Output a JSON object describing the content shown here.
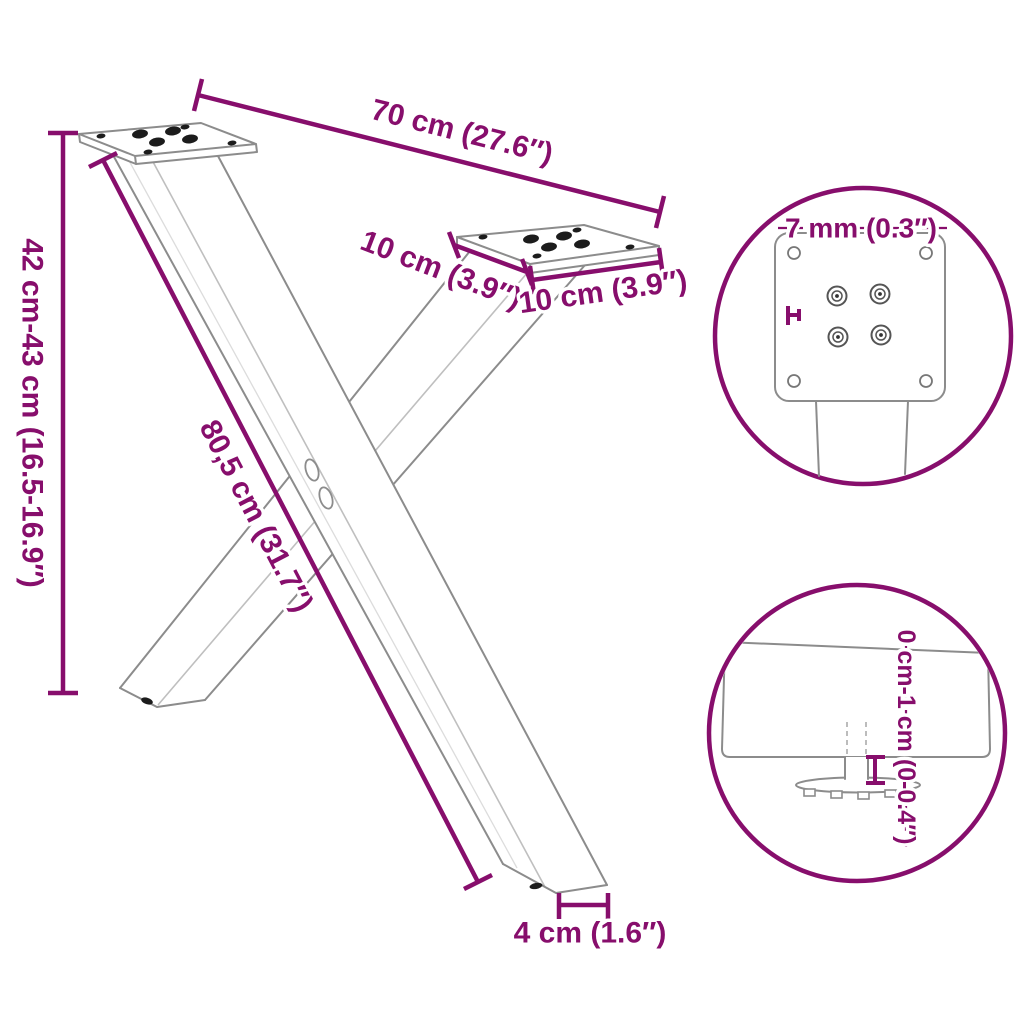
{
  "title": "X-shaped table leg dimension diagram",
  "colors": {
    "accent": "#870E6C",
    "outline": "#8c8c8c",
    "outline_light": "#bfbfbf",
    "background": "#ffffff"
  },
  "labels": {
    "top_width": "70 cm (27.6″)",
    "height_range": "42 cm-43 cm (16.5-16.9″)",
    "diagonal_length": "80,5 cm (31.7″)",
    "plate_side_left": "10 cm (3.9″)",
    "plate_side_front": "10 cm (3.9″)",
    "foot_width": "4 cm (1.6″)",
    "plate_thickness": "7 mm (0.3″)",
    "foot_height_adjust": "0 cm-1 cm (0-0.4″)"
  }
}
